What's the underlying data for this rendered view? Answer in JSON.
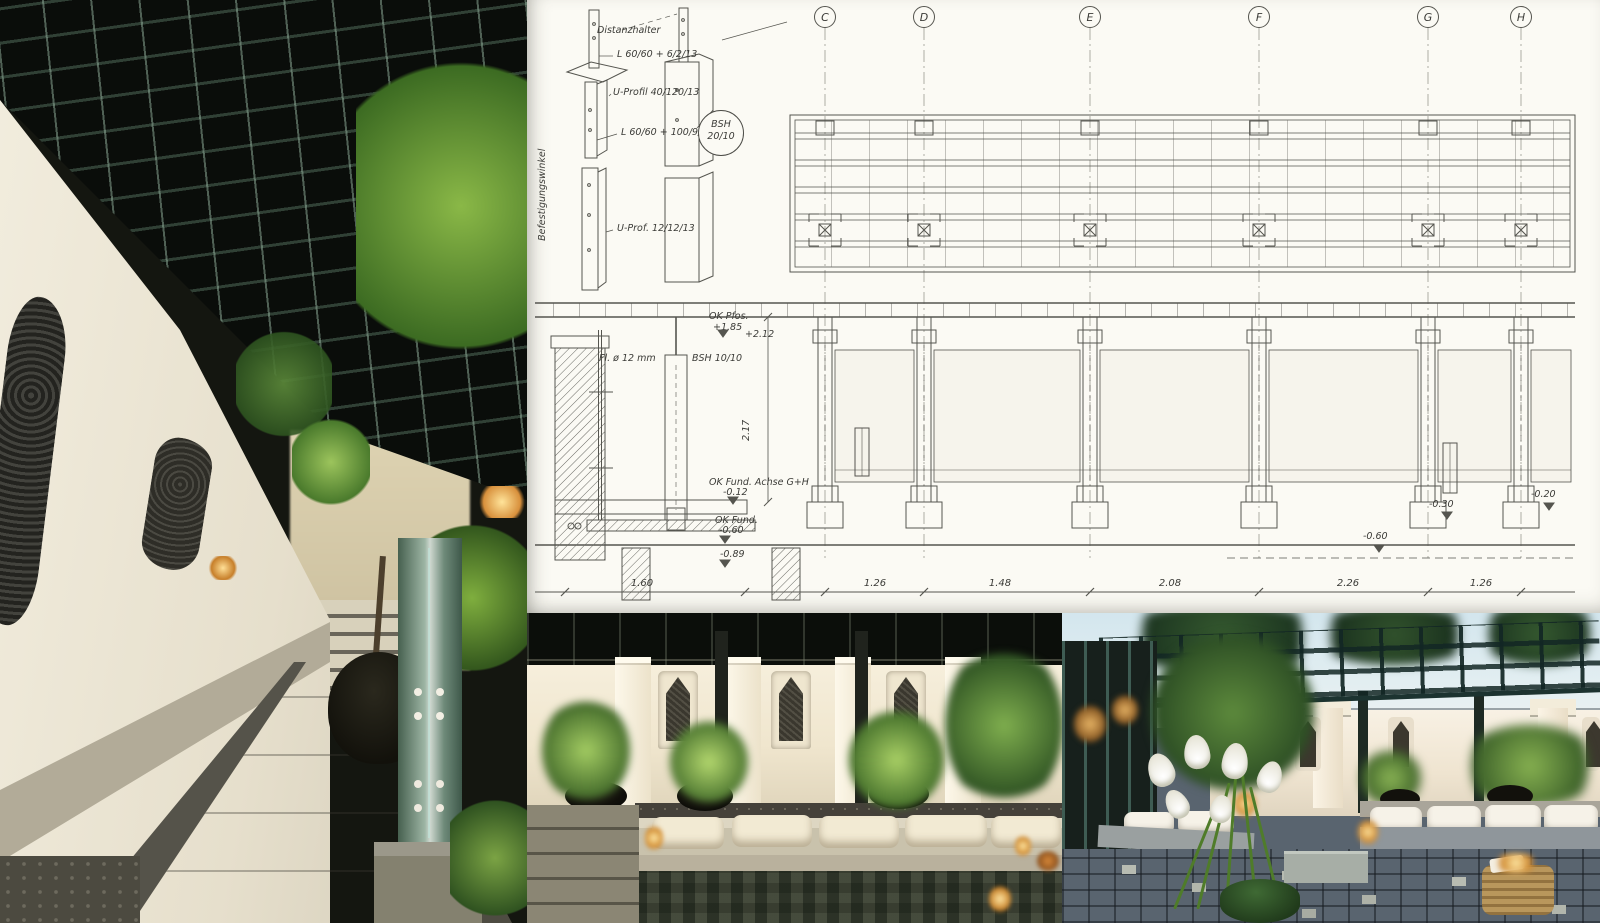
{
  "page": {
    "title": "Garden courtyard design collage"
  },
  "photos": {
    "left": {
      "alt": "Narrow garden walkway at dusk under a dark steel pergola grid; white stucco wall with carved ornaments, stone slab path with pebble borders, maple in black pot, teal steel post with bolt holes"
    },
    "middle": {
      "alt": "Courtyard lounge at night: lit white wall panels with three carved niche ornaments, plants in black bowls, cream cushions on a low stone bench, candles, dark mosaic paving"
    },
    "right": {
      "alt": "Evening patio under an open steel pergola: white wall with niches, low bench with white cushions, white calla lilies in a green pot, granite sett paving, rattan cube with candle"
    }
  },
  "sketch": {
    "grid_labels": [
      "C",
      "D",
      "E",
      "F",
      "G",
      "H"
    ],
    "detail": {
      "note_distance_holder": "Distanzhalter",
      "note_angle_top": "L 60/60 + 6/2/13",
      "note_u_profile": "U-Profil 40/120/13",
      "note_angle_bottom": "L 60/60 + 100/9/13",
      "note_bracket": "Befestigungswinkel",
      "note_u_prof_small": "U-Prof. 12/12/13",
      "bubble_line1": "BSH",
      "bubble_line2": "20/10"
    },
    "section": {
      "flat_steel": "Fl. ø 12 mm",
      "post_label": "BSH 10/10",
      "top_of_post": "OK Pfos.",
      "top_of_post_level": "+1.85",
      "beam_level": "+2.12",
      "height_dim": "2.17"
    },
    "levels": {
      "foundation_axis_label": "OK Fund. Achse G+H",
      "foundation_axis_level": "-0.12",
      "foundation_label": "OK Fund.",
      "foundation_level": "-0.60",
      "excavation_level": "-0.89",
      "level_right_wall": "-0.20",
      "level_right_base": "-0.30",
      "level_right_foot": "-0.60"
    },
    "dimensions": [
      "1.60",
      "1.26",
      "1.48",
      "2.08",
      "2.26",
      "1.26"
    ]
  },
  "palette": {
    "paper": "#fbfaf4",
    "ink": "#4a4a46",
    "pergola_dark": "#0c100c",
    "steel_teal": "#5f7d70",
    "wall_warm_white": "#efe8d6",
    "foliage_green": "#6f9c3f",
    "stone_gray": "#b2ac9c",
    "night_floor": "#20241c",
    "sky_blue": "#d3e6ee",
    "candle_glow": "#ffe49a",
    "cobble_blue_gray": "#59646f",
    "rattan_tan": "#b9975c"
  }
}
